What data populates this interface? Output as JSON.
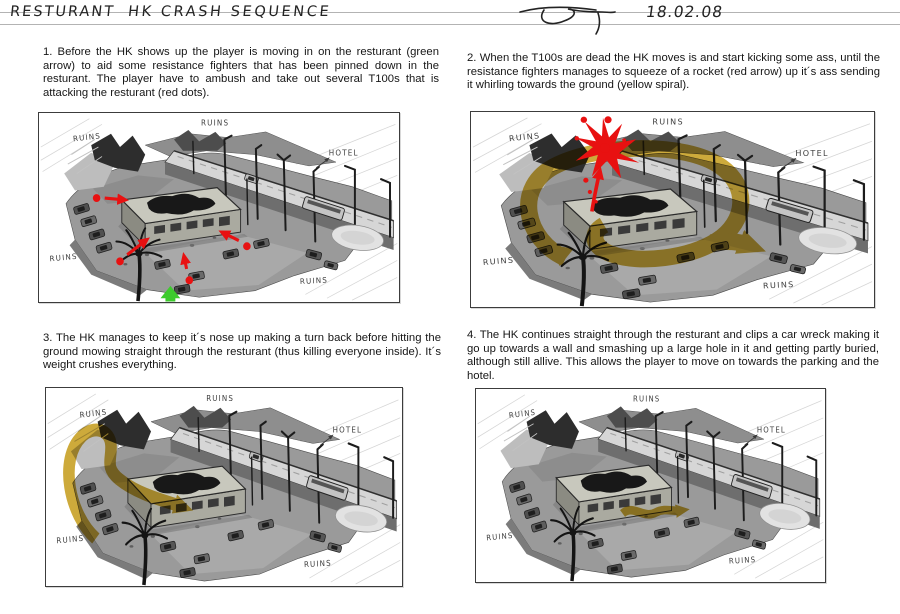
{
  "header": {
    "title_project": "RESTURANT",
    "title_sequence": "HK CRASH SEQUENCE",
    "date": "18.02.08"
  },
  "scene": {
    "labels": {
      "ruins": "RUINS",
      "hotel": "HOTEL"
    }
  },
  "colors": {
    "annotation_red": "#e81111",
    "annotation_green": "#3ecb2e",
    "annotation_yellow": "#c49a15"
  },
  "panels": [
    {
      "caption": "1. Before the HK shows up the player is moving in on the resturant (green arrow) to aid some resistance fighters that has been pinned down in the resturant. The player have to ambush and take out several T100s that is attacking the resturant (red dots)."
    },
    {
      "caption": "2. When the T100s are dead the HK moves is and start kicking some ass, until the resistance fighters manages to squeeze of a rocket (red arrow) up it´s ass sending it whirling towards the ground (yellow spiral)."
    },
    {
      "caption": "3. The HK manages to keep it´s nose up making a turn back before hitting the ground mowing straight through the resturant (thus killing everyone inside). It´s weight crushes everything."
    },
    {
      "caption": "4. The HK continues straight through the resturant and clips a car wreck making it go up towards a wall and smashing up a large hole in it and getting partly buried, although still allive. This allows the player to move on towards the parking and the hotel."
    }
  ]
}
